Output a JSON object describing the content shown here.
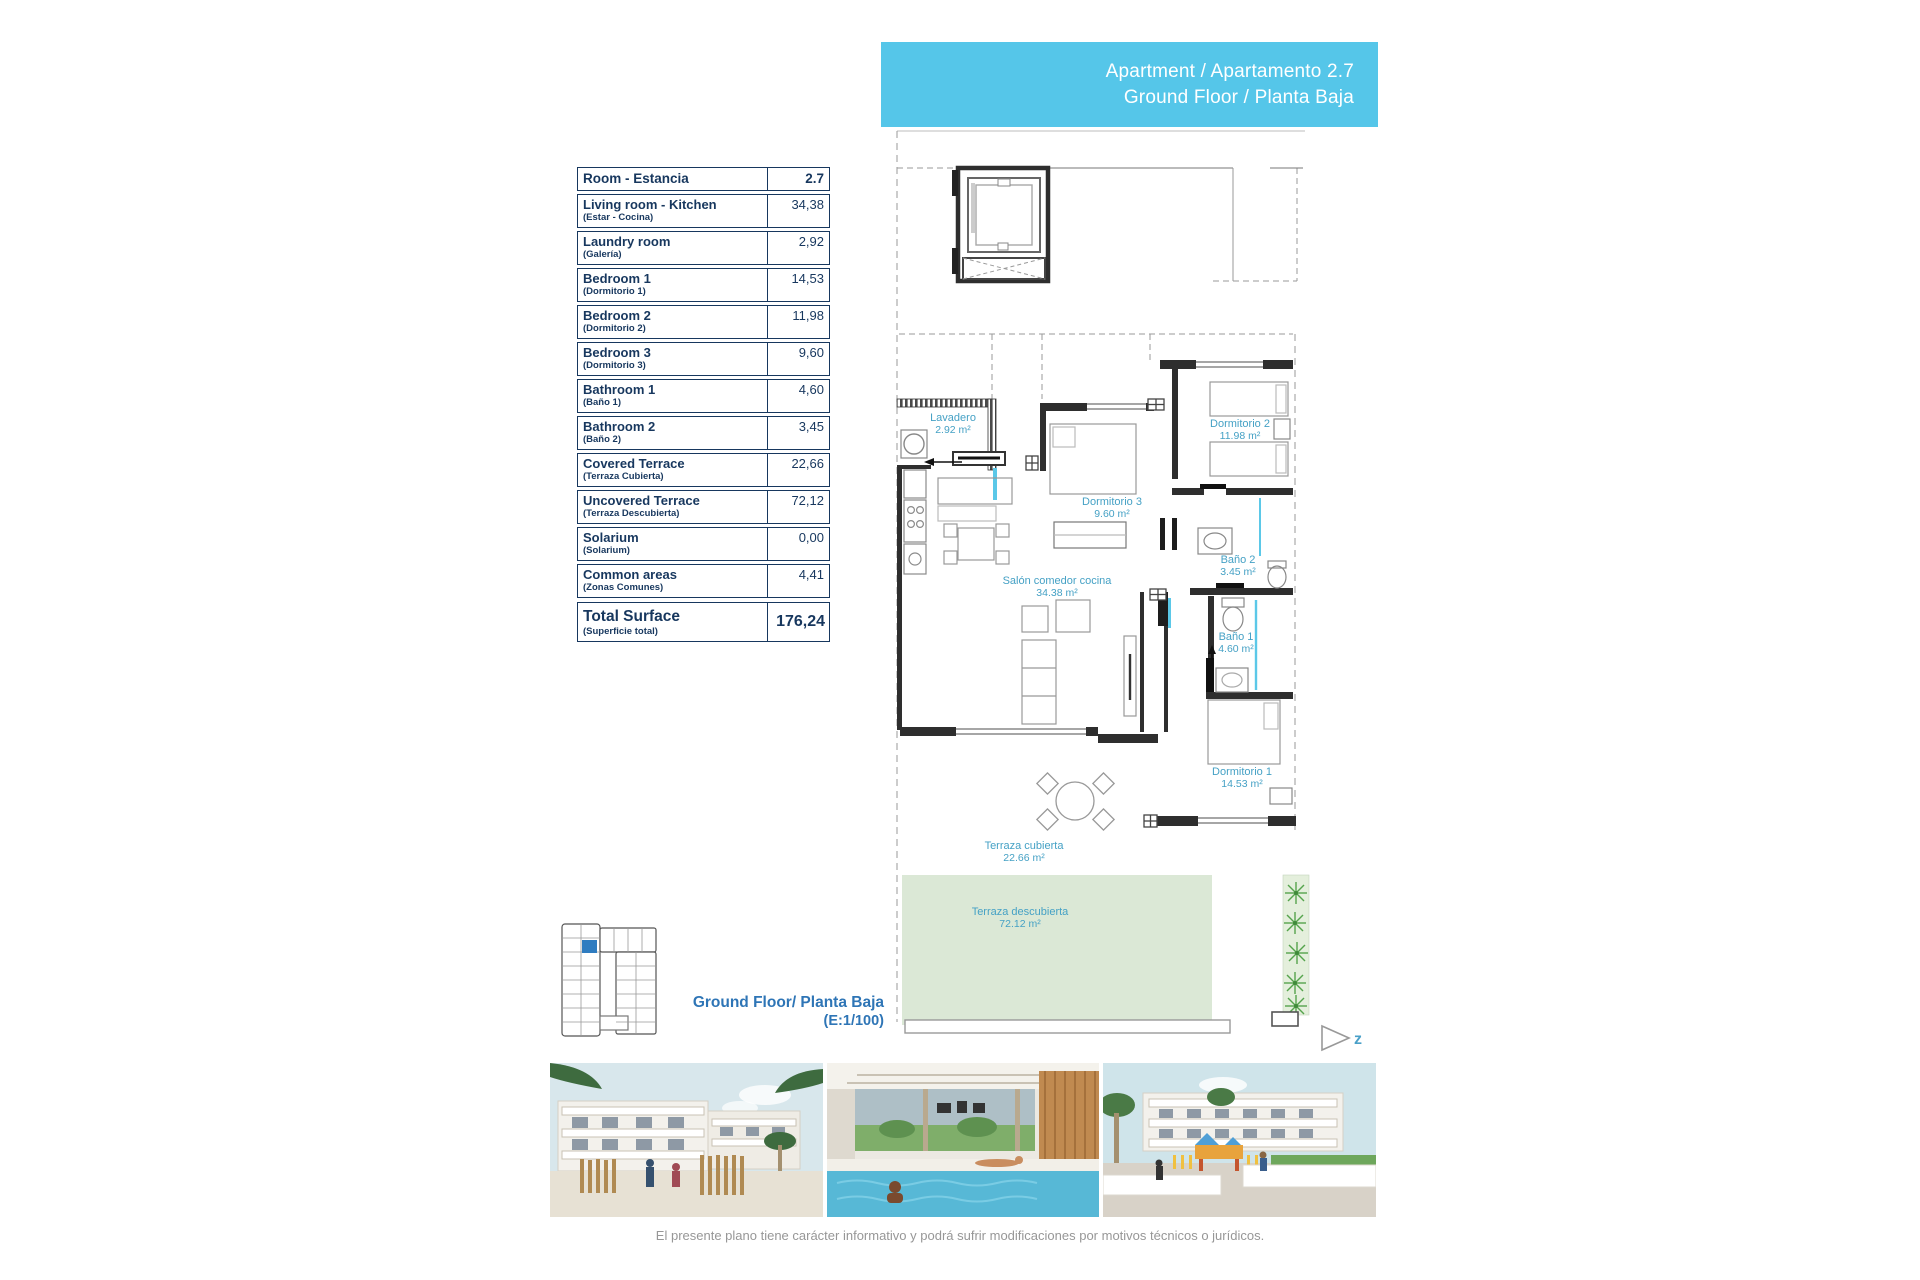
{
  "banner": {
    "line1": "Apartment / Apartamento 2.7",
    "line2": "Ground Floor / Planta Baja",
    "bg_color": "#55c6e9"
  },
  "surface_table": {
    "header": {
      "label": "Room - Estancia",
      "value": "2.7"
    },
    "rows": [
      {
        "label": "Living room - Kitchen",
        "sublabel": "(Estar - Cocina)",
        "value": "34,38"
      },
      {
        "label": "Laundry room",
        "sublabel": "(Galería)",
        "value": "2,92"
      },
      {
        "label": "Bedroom 1",
        "sublabel": "(Dormitorio 1)",
        "value": "14,53"
      },
      {
        "label": "Bedroom 2",
        "sublabel": "(Dormitorio 2)",
        "value": "11,98"
      },
      {
        "label": "Bedroom 3",
        "sublabel": "(Dormitorio 3)",
        "value": "9,60"
      },
      {
        "label": "Bathroom 1",
        "sublabel": "(Baño 1)",
        "value": "4,60"
      },
      {
        "label": "Bathroom 2",
        "sublabel": "(Baño 2)",
        "value": "3,45"
      },
      {
        "label": "Covered Terrace",
        "sublabel": "(Terraza Cubierta)",
        "value": "22,66"
      },
      {
        "label": "Uncovered Terrace",
        "sublabel": "(Terraza Descubierta)",
        "value": "72,12"
      },
      {
        "label": "Solarium",
        "sublabel": "(Solarium)",
        "value": "0,00"
      },
      {
        "label": "Common areas",
        "sublabel": "(Zonas Comunes)",
        "value": "4,41"
      }
    ],
    "total": {
      "label": "Total Surface",
      "sublabel": "(Superficie total)",
      "value": "176,24"
    }
  },
  "floorplan": {
    "rooms": [
      {
        "name": "Lavadero",
        "area": "2.92 m²"
      },
      {
        "name": "Dormitorio 2",
        "area": "11.98 m²"
      },
      {
        "name": "Dormitorio 3",
        "area": "9.60 m²"
      },
      {
        "name": "Salón comedor cocina",
        "area": "34.38 m²"
      },
      {
        "name": "Baño 2",
        "area": "3.45 m²"
      },
      {
        "name": "Baño 1",
        "area": "4.60 m²"
      },
      {
        "name": "Dormitorio 1",
        "area": "14.53 m²"
      },
      {
        "name": "Terraza cubierta",
        "area": "22.66 m²"
      },
      {
        "name": "Terraza descubierta",
        "area": "72.12 m²"
      }
    ],
    "north_label": "z",
    "label_color": "#45a1c5",
    "terrace_green": "#dbe8d6",
    "highlight_unit_color": "#2f7cc0"
  },
  "caption": {
    "line1": "Ground Floor/ Planta Baja",
    "line2": "(E:1/100)"
  },
  "photos": {
    "items": [
      {
        "name": "exterior-street-render"
      },
      {
        "name": "pool-pergola-render"
      },
      {
        "name": "playground-render"
      }
    ]
  },
  "footer": {
    "disclaimer": "El presente plano tiene carácter informativo y podrá sufrir modificaciones por motivos técnicos o jurídicos."
  }
}
